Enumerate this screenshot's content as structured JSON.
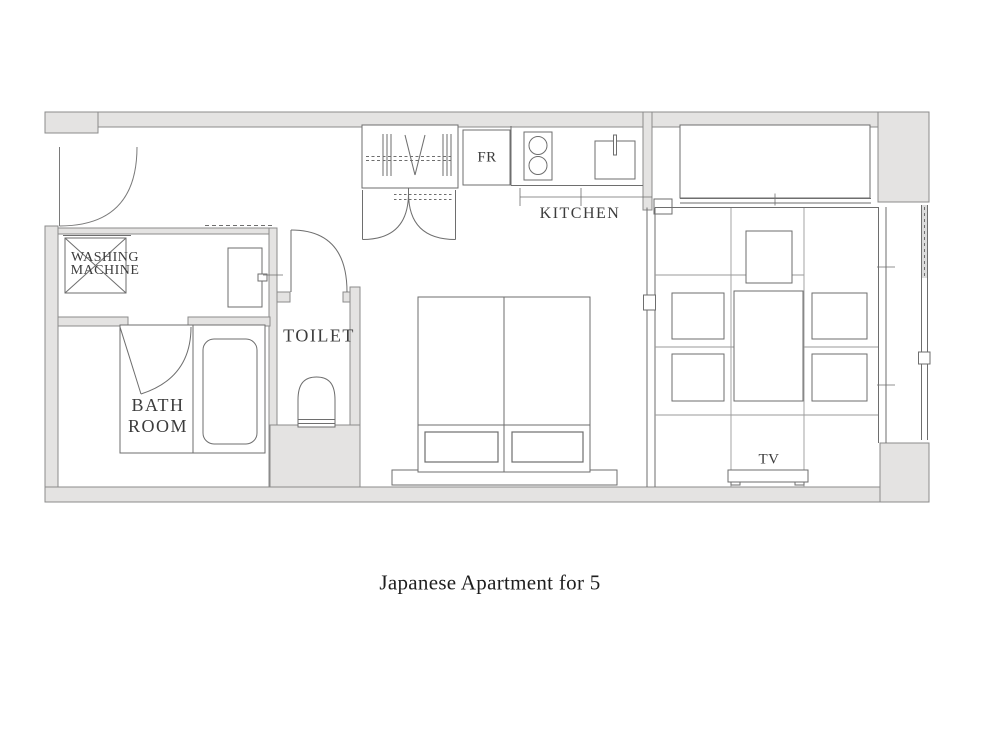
{
  "title": "Japanese Apartment for 5",
  "labels": {
    "washing_machine": "WASHING\nMACHINE",
    "bath_room": "BATH\nROOM",
    "toilet": "TOILET",
    "kitchen": "KITCHEN",
    "fridge": "FR",
    "tv": "TV"
  },
  "colors": {
    "background": "#ffffff",
    "wall_fill": "#e4e3e2",
    "wall_stroke": "#8b8b8b",
    "line": "#6e6e6e",
    "tatami_line": "#9a9a9a",
    "label_text": "#3c3c3c",
    "caption_text": "#1e1e1e"
  }
}
